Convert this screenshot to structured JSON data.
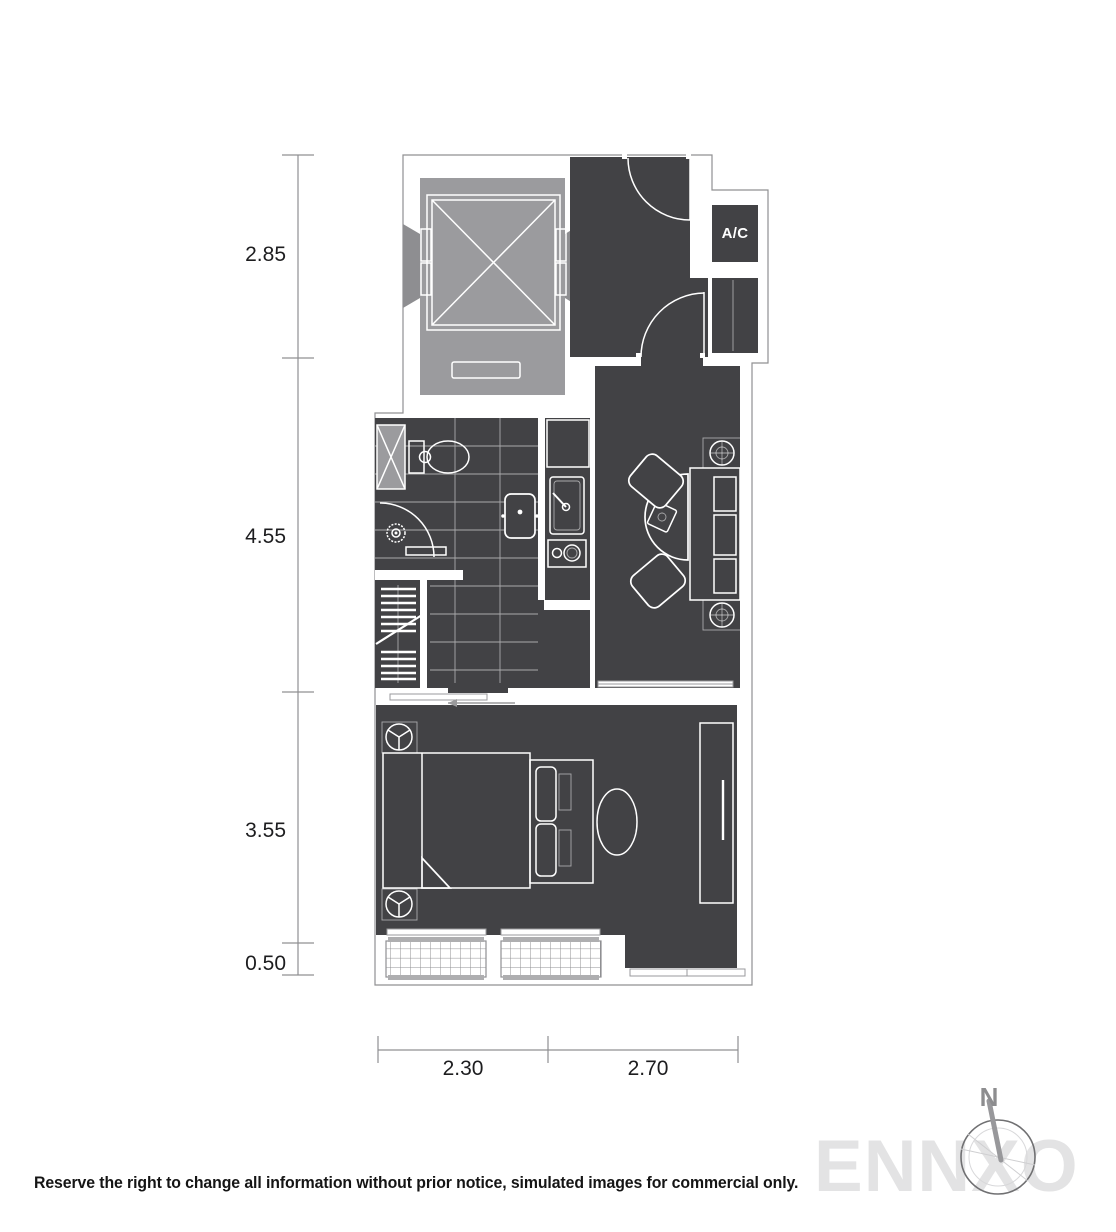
{
  "labels": {
    "ac": "A/C",
    "north": "N",
    "watermark": "ENNXO",
    "disclaimer": "Reserve the right to change all information without prior notice, simulated images for commercial only."
  },
  "dimensions": {
    "vertical": [
      {
        "label": "2.85"
      },
      {
        "label": "4.55"
      },
      {
        "label": "3.55"
      },
      {
        "label": "0.50"
      }
    ],
    "horizontal": [
      {
        "label": "2.30"
      },
      {
        "label": "2.70"
      }
    ]
  },
  "colors": {
    "background": "#ffffff",
    "floor_dark": "#424245",
    "elevator_gray": "#9b9b9e",
    "dimension_text": "#1d1d1f",
    "watermark_gray": "#e3e3e4",
    "compass_gray": "#8d8d8f"
  }
}
